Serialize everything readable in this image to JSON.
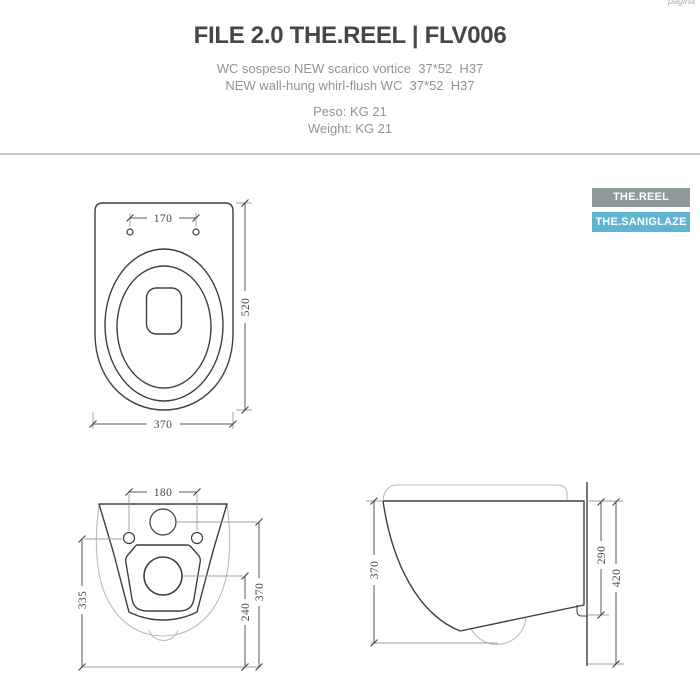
{
  "header": {
    "title": "FILE 2.0 THE.REEL | FLV006",
    "subtitle_line1": "WC sospeso NEW scarico vortice  37*52  H37",
    "subtitle_line2": "NEW wall-hung whirl-flush WC  37*52  H37",
    "weight_line1": "Peso: KG 21",
    "weight_line2": "Weight: KG 21",
    "corner_note": "pagina"
  },
  "badges": [
    {
      "label": "THE.REEL",
      "bg": "#8f9a9b"
    },
    {
      "label": "THE.SANIGLAZE",
      "bg": "#5fb5d2"
    }
  ],
  "drawings": {
    "top_view": {
      "dim_holes_spacing": "170",
      "dim_depth": "520",
      "dim_width": "370"
    },
    "rear_view": {
      "dim_holes_spacing": "180",
      "dim_height_total": "335",
      "dim_inlet_height": "370",
      "dim_outlet_height": "240"
    },
    "side_view": {
      "dim_depth": "370",
      "dim_back_height": "290",
      "dim_total_height": "420"
    }
  },
  "colors": {
    "title": "#42474c",
    "subtitle": "#8e9497",
    "divider": "#c4c9cb",
    "badge_reel_bg": "#8f9a9b",
    "badge_saniglaze_bg": "#5fb5d2",
    "line_dark": "#3c4043",
    "line_light": "#b9bdbf",
    "dim_text": "#44484c"
  }
}
